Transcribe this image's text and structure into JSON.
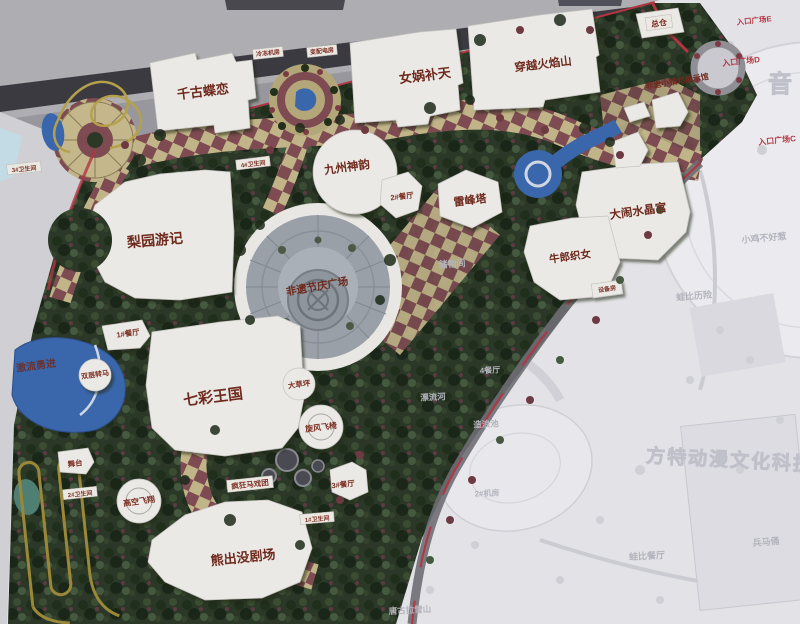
{
  "colors": {
    "vegetation": "#2c3827",
    "path_tan": "#c2b489",
    "path_maroon": "#7d4b51",
    "water": "#3a66ab",
    "building": "#eae9e6",
    "board_red_trim": "#b23542",
    "label_red": "#6f2a1d",
    "faint_area": "#e3e2e6",
    "faint_label": "#b3b3bc"
  },
  "map": {
    "attractions": [
      {
        "text": "千古蝶恋"
      },
      {
        "text": "女娲补天"
      },
      {
        "text": "穿越火焰山"
      },
      {
        "text": "九州神韵"
      },
      {
        "text": "梨园游记"
      },
      {
        "text": "雷峰塔"
      },
      {
        "text": "大闹水晶宫"
      },
      {
        "text": "牛郎织女"
      },
      {
        "text": "非遗节庆广场"
      },
      {
        "text": "七彩王国"
      },
      {
        "text": "熊出没剧场"
      },
      {
        "text": "激流勇进"
      },
      {
        "text": "非遗小镇和展示馆"
      }
    ],
    "signs": [
      {
        "text": "总仓"
      },
      {
        "text": "冷冻机房"
      },
      {
        "text": "变配电房"
      },
      {
        "text": "2#餐厅"
      },
      {
        "text": "1#餐厅"
      },
      {
        "text": "3#餐厅"
      },
      {
        "text": "双层转马"
      },
      {
        "text": "大草坪"
      },
      {
        "text": "旋风飞椅"
      },
      {
        "text": "高空飞翔"
      },
      {
        "text": "疯狂马戏团"
      },
      {
        "text": "舞台"
      },
      {
        "text": "3#卫生间"
      },
      {
        "text": "4#卫生间"
      },
      {
        "text": "2#卫生间"
      },
      {
        "text": "1#卫生间"
      },
      {
        "text": "设备房"
      }
    ],
    "entrances": [
      {
        "text": "入口广场E"
      },
      {
        "text": "入口广场D"
      },
      {
        "text": "入口广场C"
      }
    ],
    "faint_labels": [
      {
        "text": "储物间"
      },
      {
        "text": "4餐厅"
      },
      {
        "text": "漂流河"
      },
      {
        "text": "造浪池"
      },
      {
        "text": "2#机房"
      },
      {
        "text": "小鸡不好惹"
      },
      {
        "text": "蛙比历险"
      },
      {
        "text": "蛙比餐厅"
      },
      {
        "text": "兵马俑"
      },
      {
        "text": "唐古拉雪山"
      }
    ],
    "watermarks": {
      "corner_char": "音",
      "park_name": "方特动漫文化科技"
    }
  }
}
